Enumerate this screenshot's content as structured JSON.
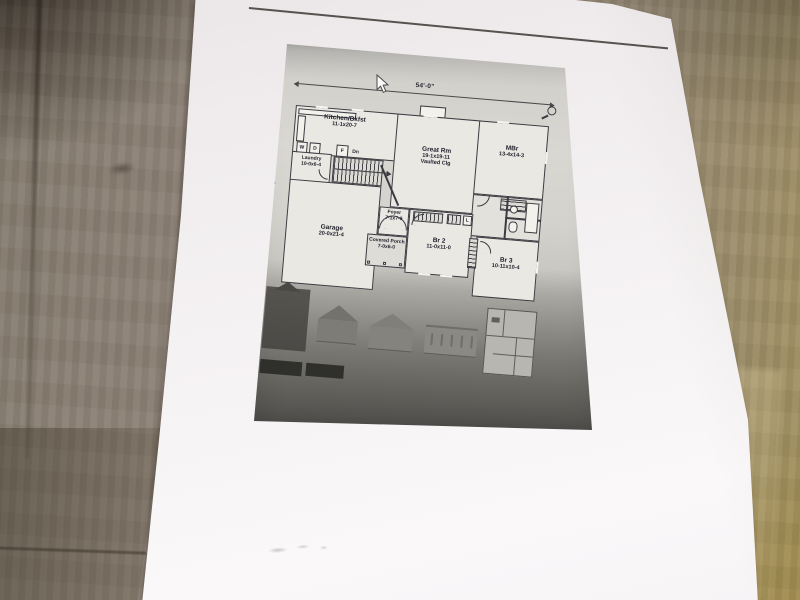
{
  "floor_plan": {
    "overall_width": "54'-0\"",
    "overall_depth": "42'-0\"",
    "rooms": [
      {
        "name": "Kitchen/Bkfst",
        "size": "11-1x20-7"
      },
      {
        "name": "Laundry",
        "size": "10-0x6-4"
      },
      {
        "name": "Great Rm",
        "size": "19-1x19-11",
        "note": "Vaulted Clg"
      },
      {
        "name": "MBr",
        "size": "13-4x14-3"
      },
      {
        "name": "Garage",
        "size": "20-0x21-4"
      },
      {
        "name": "Foyer",
        "size": "7-1x7-9"
      },
      {
        "name": "Covered Porch",
        "size": "7-0x6-0"
      },
      {
        "name": "Br 2",
        "size": "11-0x11-0"
      },
      {
        "name": "Br 3",
        "size": "10-11x10-4"
      }
    ],
    "fixtures": {
      "washer": "W",
      "dryer": "D",
      "furnace": "F",
      "stairs_down": "Dn",
      "linen": "L"
    }
  },
  "icons": {
    "magnifier": "magnifier-icon",
    "cursor": "arrow-pointer-icon"
  },
  "colors": {
    "paper": "#f5f2f3",
    "wood": "#8d8276",
    "wood_olive": "#a29260",
    "scan_light": "#d6d5d0",
    "scan_dark": "#403f3e",
    "ink": "#23232e"
  }
}
